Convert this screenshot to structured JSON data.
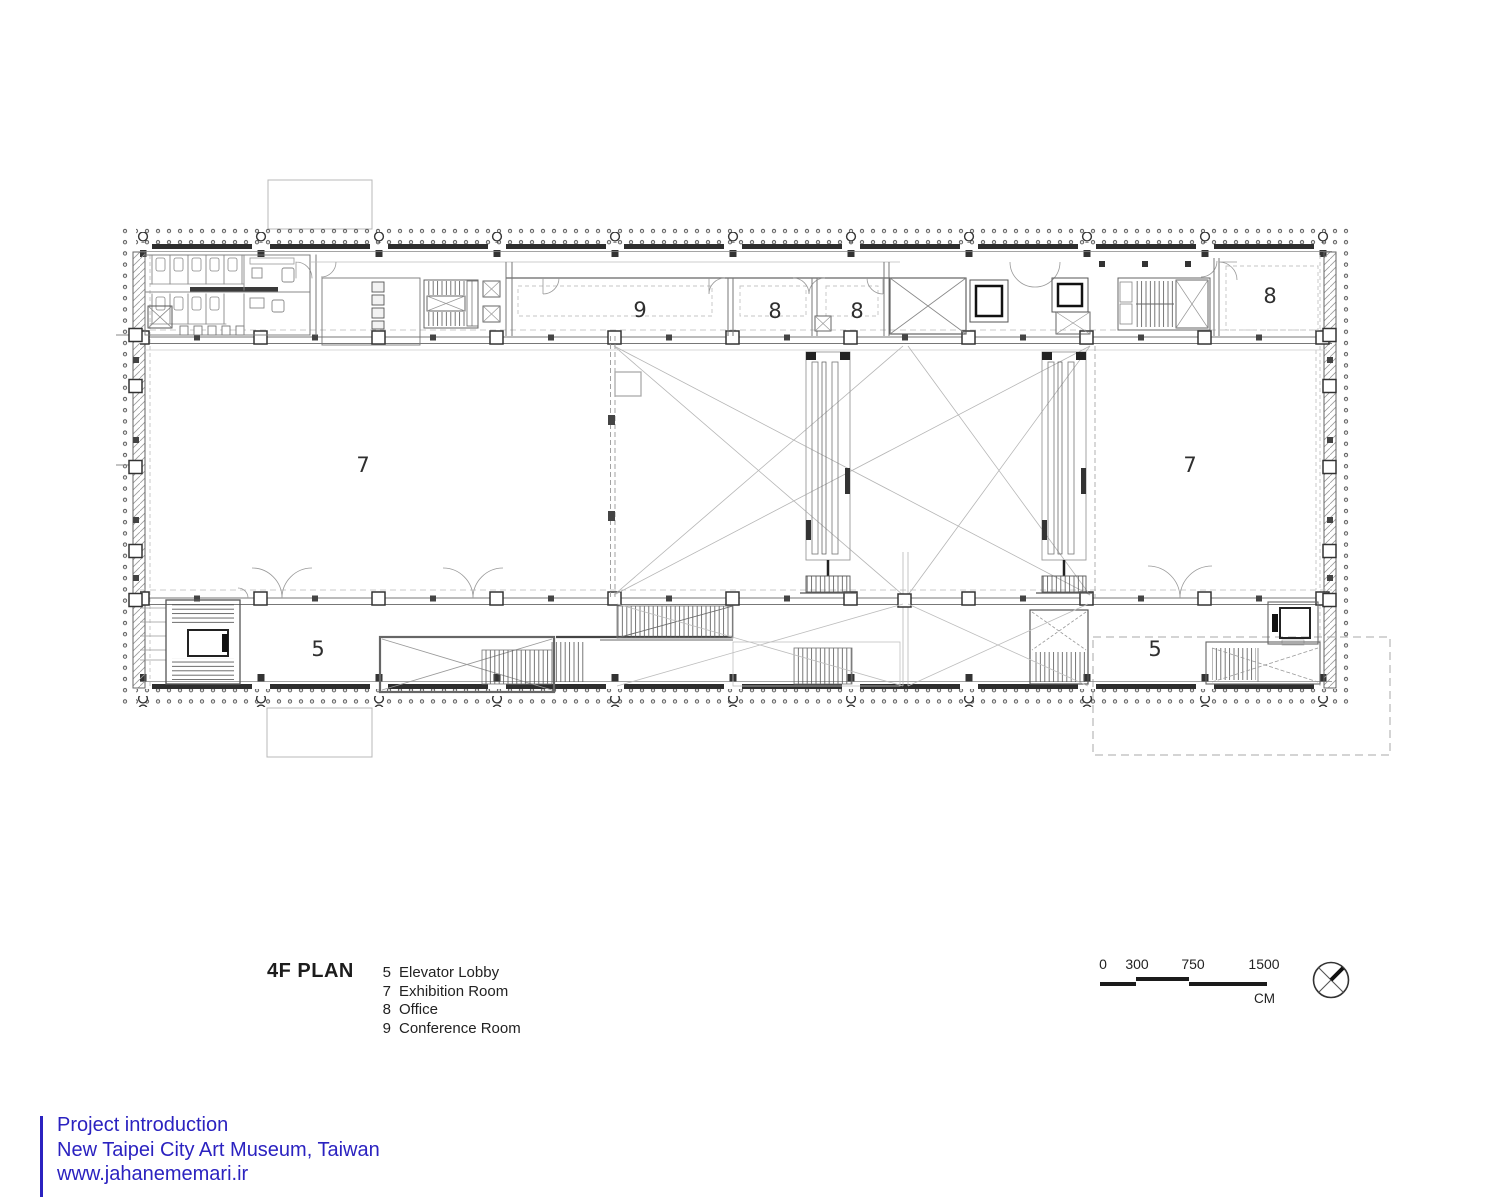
{
  "plan": {
    "title": "4F PLAN",
    "room_labels": {
      "conference": "9",
      "office_a": "8",
      "office_b": "8",
      "office_east": "8",
      "exhibition_west": "7",
      "exhibition_east": "7",
      "elevator_lobby_west": "5",
      "elevator_lobby_east": "5"
    }
  },
  "legend": {
    "items": [
      {
        "number": "5",
        "label": "Elevator Lobby"
      },
      {
        "number": "7",
        "label": "Exhibition Room"
      },
      {
        "number": "8",
        "label": "Office"
      },
      {
        "number": "9",
        "label": "Conference Room"
      }
    ]
  },
  "scale_bar": {
    "ticks": [
      "0",
      "300",
      "750",
      "1500"
    ],
    "unit": "CM"
  },
  "compass": {
    "icon": "north-arrow-circle"
  },
  "footer": {
    "accent_color": "#2b22c0",
    "lines": [
      "Project introduction",
      "New Taipei City Art Museum, Taiwan",
      "www.jahanememari.ir"
    ]
  }
}
